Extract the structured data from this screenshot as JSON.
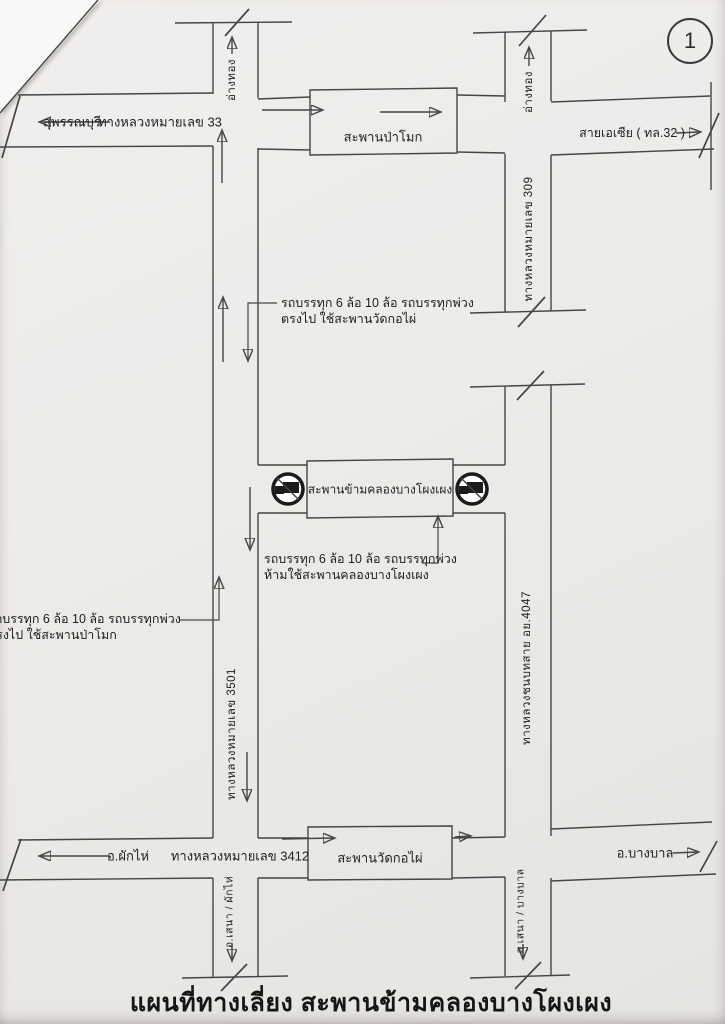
{
  "page": {
    "number": "1",
    "title": "แผนที่ทางเลี่ยง สะพานข้ามคลองบางโผงเผง"
  },
  "labels": {
    "suphanburi": "สุพรรณบุรี",
    "highway_33": "ทางหลวงหมายเลข 33",
    "angthong_left": "อ่างทอง",
    "angthong_right": "อ่างทอง",
    "pamok_bridge": "สะพานป่าโมก",
    "asia_route": "สายเอเซีย ( ทล.32 )",
    "highway_309": "ทางหลวงหมายเลข 309",
    "center_bridge": "สะพานข้ามคลองบางโผงเผง",
    "highway_3501": "ทางหลวงหมายเลข 3501",
    "rural_road_4047": "ทางหลวงชนบทสาย อย.4047",
    "phak_hai": "อ.ผักไห่",
    "highway_3412": "ทางหลวงหมายเลข 3412",
    "wat_kophai_bridge": "สะพานวัดกอไผ่",
    "bang_ban": "อ.บางบาล",
    "sena_phakhai": "อ.เสนา / ผักไห่",
    "sena_bangban": "อ.เสนา / บางบาล"
  },
  "notes": {
    "straight_kophai": {
      "line1": "รถบรรทุก 6 ล้อ 10 ล้อ รถบรรทุกพ่วง",
      "line2": "ตรงไป ใช้สะพานวัดกอไผ่"
    },
    "no_cross": {
      "line1": "รถบรรทุก 6 ล้อ 10 ล้อ รถบรรทุกพ่วง",
      "line2": "ห้ามใช้สะพานคลองบางโผงเผง"
    },
    "straight_pamok": {
      "line1": "รถบรรทุก 6 ล้อ 10 ล้อ รถบรรทุกพ่วง",
      "line2": "ตรงไป ใช้สะพานป่าโมก"
    }
  },
  "icons": {
    "no_trucks_sign": "no-trucks-sign"
  },
  "colors": {
    "paper": "#edebe8",
    "ink": "#454545",
    "sign": "#1b1b1b",
    "text": "#242424"
  }
}
